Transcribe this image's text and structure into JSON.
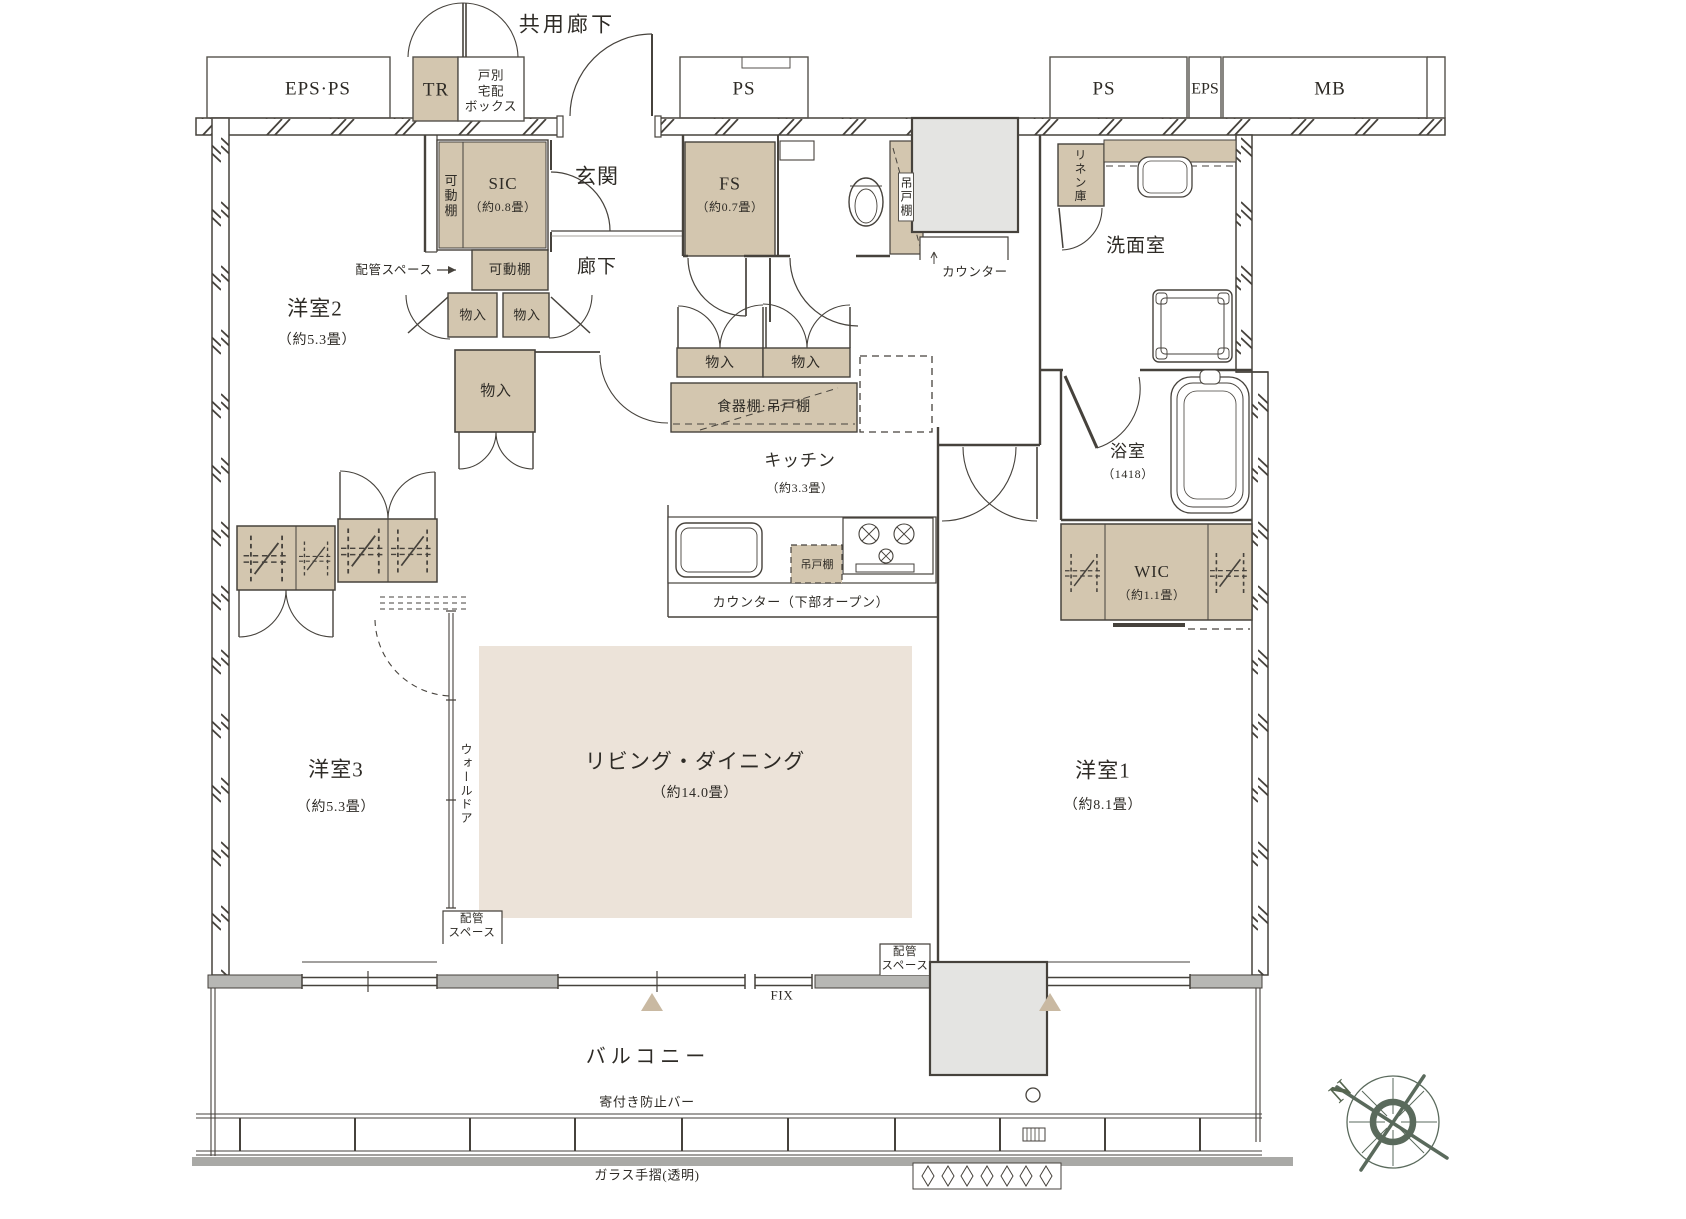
{
  "corridor": {
    "label": "共用廊下"
  },
  "service_shafts": {
    "eps_ps": "EPS·PS",
    "tr": "TR",
    "delivery_box": "戸別\n宅配\nボックス",
    "ps_center": "PS",
    "ps_right": "PS",
    "eps": "EPS",
    "mb": "MB"
  },
  "rooms": {
    "genkan": "玄関",
    "hallway": "廊下",
    "sic_name": "SIC",
    "sic_size": "（約0.8畳）",
    "fs_name": "FS",
    "fs_size": "（約0.7畳）",
    "washroom": "洗面室",
    "bath_name": "浴室",
    "bath_size": "（1418）",
    "wic_name": "WIC",
    "wic_size": "（約1.1畳）",
    "kitchen_name": "キッチン",
    "kitchen_size": "（約3.3畳）",
    "living_name": "リビング・ダイニング",
    "living_size": "（約14.0畳）",
    "bedroom1_name": "洋室1",
    "bedroom1_size": "（約8.1畳）",
    "bedroom2_name": "洋室2",
    "bedroom2_size": "（約5.3畳）",
    "bedroom3_name": "洋室3",
    "bedroom3_size": "（約5.3畳）",
    "balcony": "バルコニー"
  },
  "storage": {
    "movable_shelf_sic": "可動棚",
    "movable_shelf": "可動棚",
    "monoire_small_a": "物入",
    "monoire_small_b": "物入",
    "monoire_large": "物入",
    "monoire_hall_a": "物入",
    "monoire_hall_b": "物入",
    "cupboard": "食器棚·吊戸棚",
    "hanging_shelf_wc": "吊戸棚",
    "hanging_shelf_kitchen": "吊戸棚",
    "linen": "リネン庫",
    "wall_door": "ウォールドア"
  },
  "annotations": {
    "pipe_space_arrow": "配管スペース",
    "counter": "カウンター",
    "counter_open": "カウンター（下部オープン）",
    "pipe_space_left": "配管\nスペース",
    "pipe_space_right": "配管\nスペース",
    "fix": "FIX",
    "anti_loitering_bar": "寄付き防止バー",
    "glass_handrail": "ガラス手摺(透明)",
    "north": "N"
  },
  "colors": {
    "storage_fill": "#d3c6af",
    "floor_fill": "#ece3d9",
    "shaft_fill": "#e4e4e2",
    "wall_line": "#46423c",
    "compass": "#5a6a5c"
  }
}
